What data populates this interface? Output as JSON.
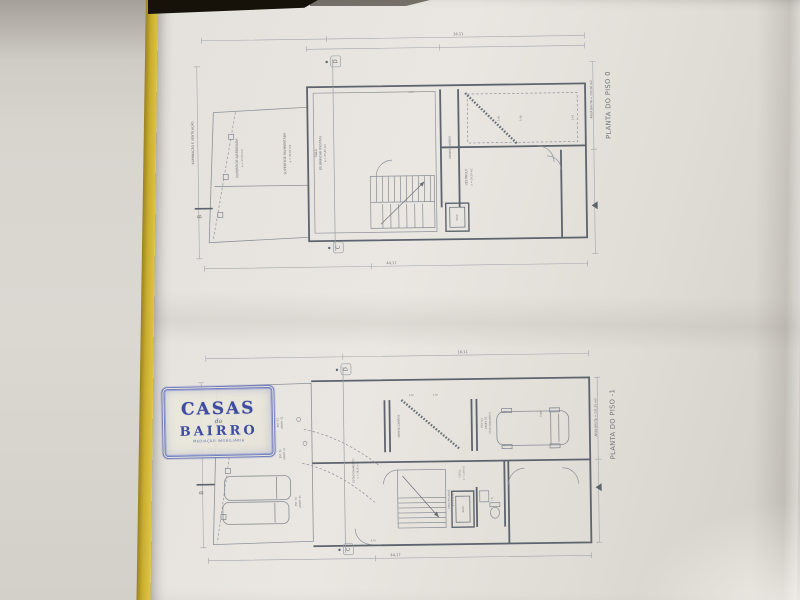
{
  "logo": {
    "line1": "CASAS",
    "line2": "do",
    "line3": "BAIRRO",
    "tagline": "MEDIAÇÃO IMOBILIÁRIA",
    "frame_color": "#6b78bd",
    "text_color": "#32419e"
  },
  "plan0": {
    "title": "PLANTA DO PISO 0",
    "area_note": "ÁREA BRUTA = 132,00 m2",
    "labels": {
      "iluminacao": "ILUMINAÇÃO E VENTILAÇÃO",
      "ajardinada": "SUPERFÍCIE AJARDINADA",
      "ajardinada_area": "a = 17,00 m2",
      "pavimentada": "SUPERFÍCIE PAVIMENTADA",
      "pavimentada_area": "a = 35,60 m2",
      "sala": "SALA",
      "sala2": "DE BRINCAR (FESTAS)",
      "sala_area": "a = 25,40 m2",
      "monta_carros": "MONTA CARROS",
      "vestibulo": "VESTÍBULO",
      "vestibulo_area": "a = 18,20 m2",
      "elev": "ELEV."
    },
    "markers": {
      "top": "D",
      "bottom": "C",
      "side": "B"
    },
    "dims": [
      "16,11",
      "44,17",
      "3,40",
      "5,40",
      "2,45",
      "0,90"
    ]
  },
  "plan1": {
    "title": "PLANTA DO PISO -1",
    "area_note": "ÁREA BRUTA = 131,20 m2",
    "labels": {
      "est03": "EST. 03",
      "est03b": "APART. 02",
      "est02": "EST. 02",
      "est02b": "APART. 01",
      "est01": "EST. 01",
      "est01b": "APART. 01",
      "est04": "EST. 04",
      "est04b": "APART. 02",
      "est04c": "ESTACIONAMENTO",
      "estacionamento": "ESTACIONAMENTO",
      "estacionamento_area": "a = 19,50 m2",
      "monta_carros": "MONTA CARROS",
      "casa_escadas": "CASA ESCADAS",
      "casa_escadas_area": "a = 4,70 m2",
      "elev": "ELEV.",
      "circul": "CIRCUL.",
      "circul_area": "a = 11,60 m2",
      "wc": "I.S."
    },
    "markers": {
      "top": "D",
      "bottom": "C",
      "side": "B"
    },
    "dims": [
      "16,11",
      "44,17",
      "0,90",
      "2,30",
      "5,00",
      "4,70"
    ]
  }
}
